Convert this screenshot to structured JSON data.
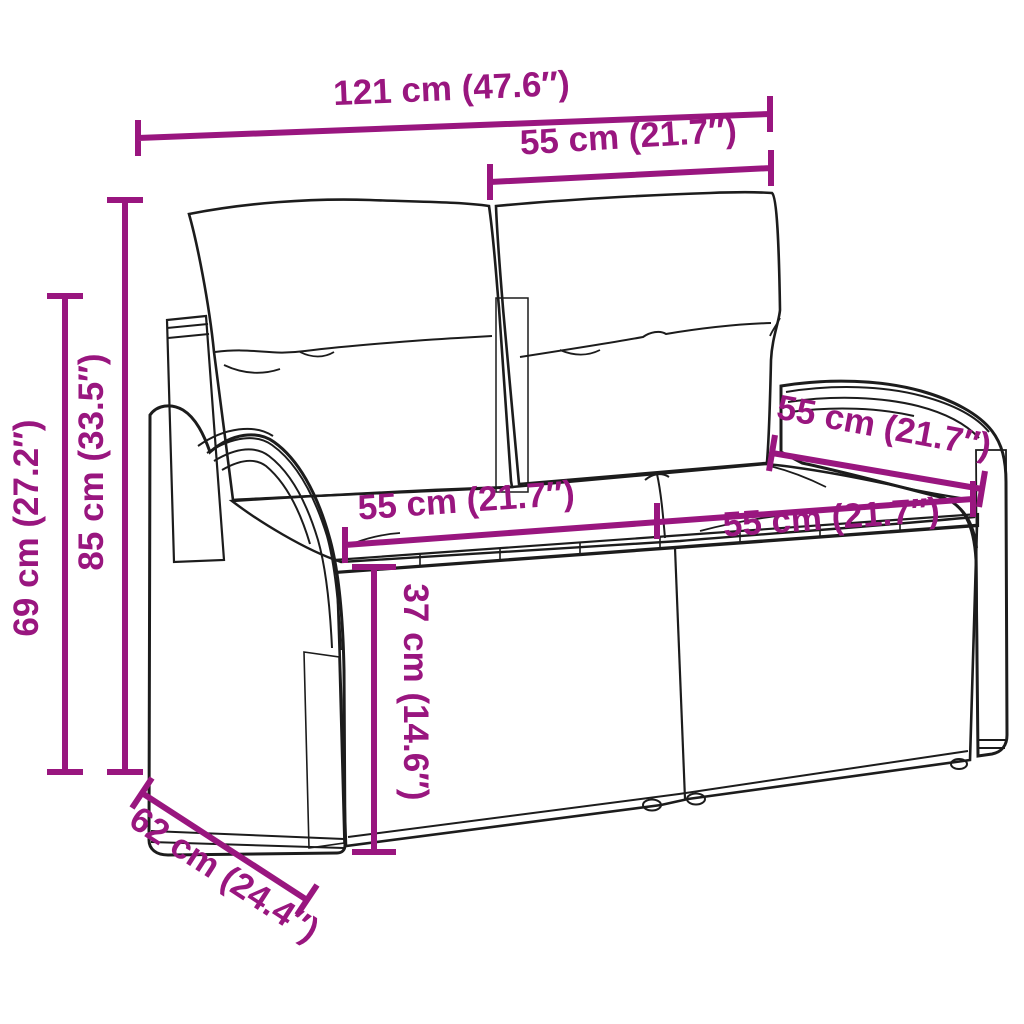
{
  "figure": {
    "background_color": "#ffffff",
    "accent_color": "#99167f",
    "line_art_color": "#1c1c1c"
  },
  "labels": {
    "overall_width": "121 cm (47.6″)",
    "backrest_width": "55 cm (21.7″)",
    "overall_height": "85 cm (33.5″)",
    "armrest_height": "69 cm (27.2″)",
    "seat_width_left": "55 cm (21.7″)",
    "seat_width_right": "55 cm (21.7″)",
    "seat_depth": "55 cm (21.7″)",
    "seat_height": "37 cm (14.6″)",
    "overall_depth": "62 cm (24.4″)"
  }
}
